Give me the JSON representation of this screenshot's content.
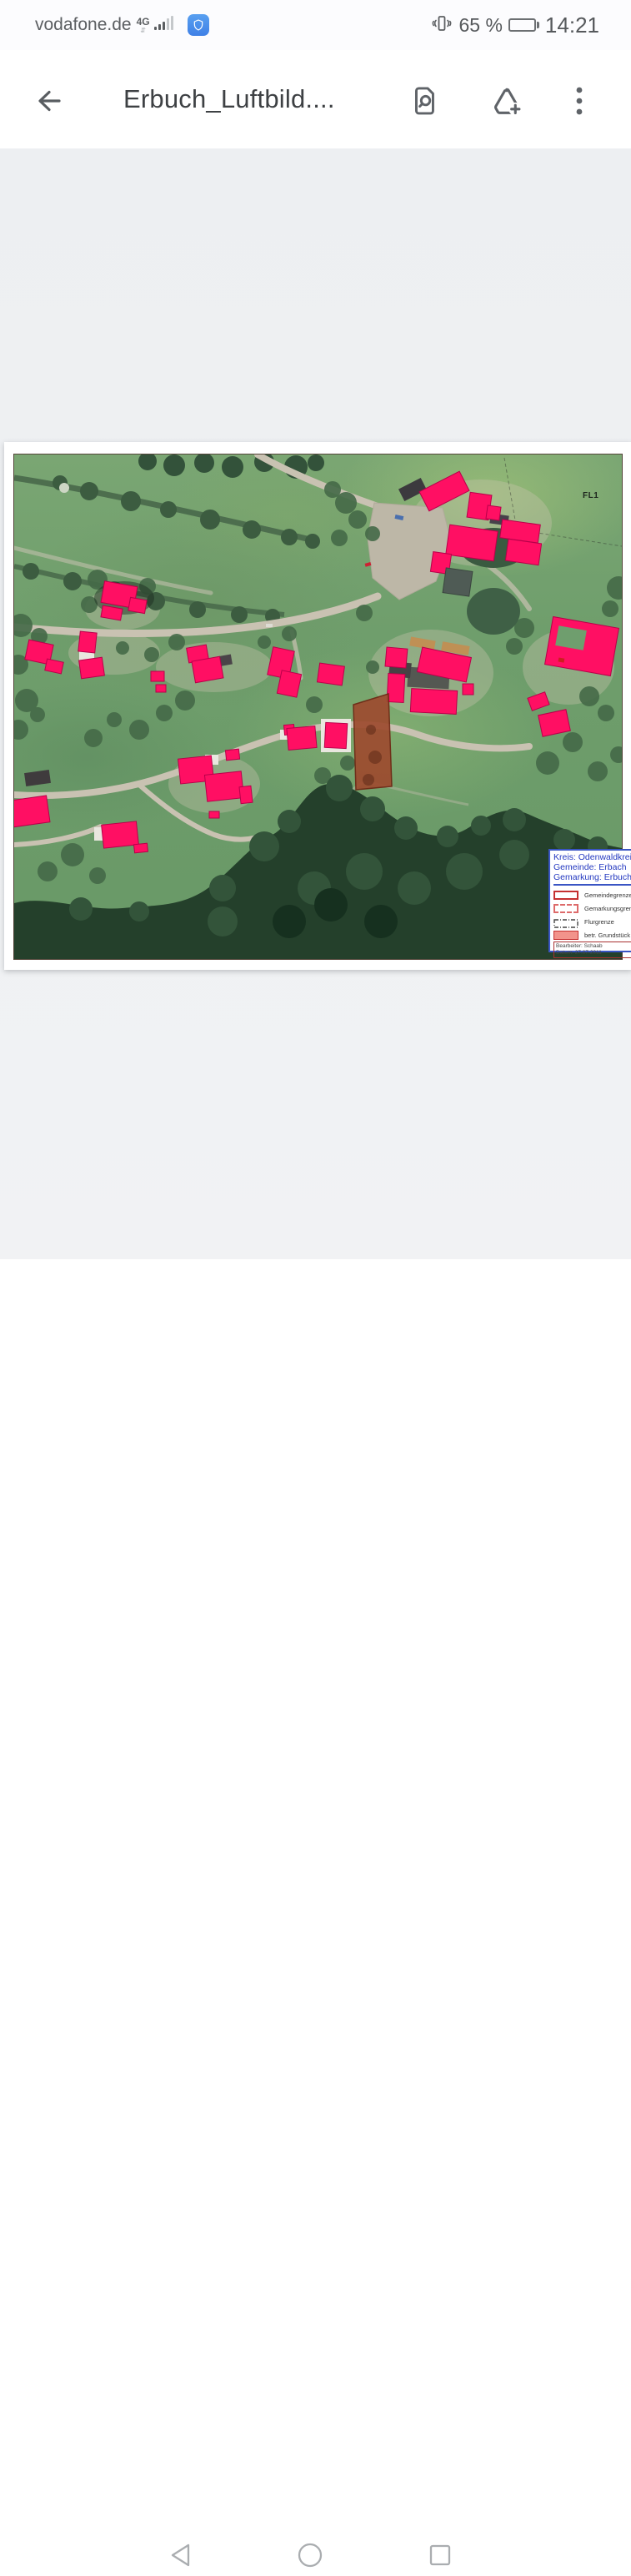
{
  "status_bar": {
    "carrier": "vodafone.de",
    "network": "4G",
    "battery_text": "65 %",
    "time": "14:21",
    "icons": [
      "signal-bars-icon",
      "network-activity-icon",
      "phone-manager-shield-icon",
      "vibrate-icon",
      "battery-icon"
    ]
  },
  "header": {
    "title": "Erbuch_Luftbild....",
    "icons": [
      "back-arrow-icon",
      "find-in-document-icon",
      "add-to-drive-icon",
      "overflow-menu-icon"
    ]
  },
  "map": {
    "field_label": "FL1",
    "colors": {
      "highlight_pink": "#ff0f63",
      "parcel_brown": "#9d4b2f",
      "legend_blue": "#2338c0",
      "legend_red": "#c53030",
      "road": "#c9c2b2"
    },
    "legend": {
      "line1": "Kreis: Odenwaldkreis",
      "line2": "Gemeinde: Erbach",
      "line3": "Gemarkung: Erbuch",
      "items": [
        {
          "label": "Gemeindegrenze",
          "symbol": "red-solid-outline"
        },
        {
          "label": "Gemarkungsgrenze",
          "symbol": "red-dashed-outline"
        },
        {
          "label": "Flurgrenze",
          "symbol": "black-dashdot-outline"
        },
        {
          "label": "betr. Grundstück",
          "symbol": "salmon-filled"
        }
      ],
      "editor": "Bearbeiter: Schaab",
      "date": "Datum: 27.07.2011"
    }
  },
  "nav": {
    "icons": [
      "back-triangle-icon",
      "home-circle-icon",
      "recents-square-icon"
    ]
  }
}
